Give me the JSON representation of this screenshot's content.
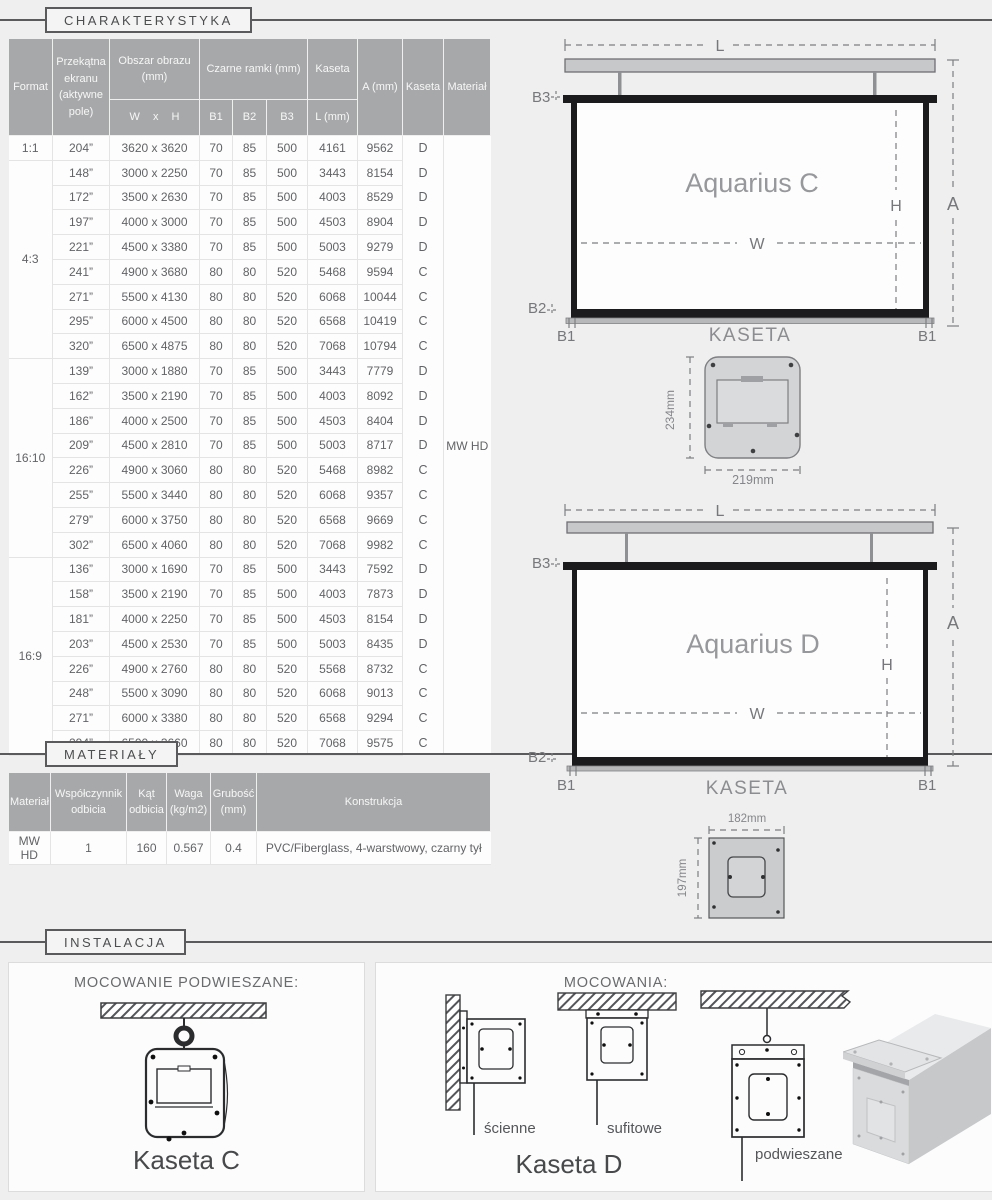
{
  "colors": {
    "accent": "#5a5a5c",
    "table_header": "#a7a8aa",
    "page_bg": "#efefef"
  },
  "sections": {
    "charakterystyka": "CHARAKTERYSTYKA",
    "materialy": "MATERIAŁY",
    "instalacja": "INSTALACJA"
  },
  "spec_table": {
    "header": {
      "format": "Format",
      "diagonal": "Przekątna ekranu (aktywne pole)",
      "image_area": "Obszar obrazu (mm)",
      "image_area_sub": "W x H",
      "black_frames": "Czarne ramki (mm)",
      "b1": "B1",
      "b2": "B2",
      "b3": "B3",
      "kaseta": "Kaseta",
      "kaseta_sub": "L (mm)",
      "a": "A (mm)",
      "kaseta2": "Kaseta",
      "material": "Materiał"
    },
    "material_value": "MW HD",
    "groups": [
      {
        "format": "1:1",
        "rows": [
          [
            "204”",
            "3620 x 3620",
            "70",
            "85",
            "500",
            "4161",
            "9562",
            "D"
          ]
        ]
      },
      {
        "format": "4:3",
        "rows": [
          [
            "148”",
            "3000 x 2250",
            "70",
            "85",
            "500",
            "3443",
            "8154",
            "D"
          ],
          [
            "172”",
            "3500 x 2630",
            "70",
            "85",
            "500",
            "4003",
            "8529",
            "D"
          ],
          [
            "197”",
            "4000 x 3000",
            "70",
            "85",
            "500",
            "4503",
            "8904",
            "D"
          ],
          [
            "221”",
            "4500 x 3380",
            "70",
            "85",
            "500",
            "5003",
            "9279",
            "D"
          ],
          [
            "241”",
            "4900 x 3680",
            "80",
            "80",
            "520",
            "5468",
            "9594",
            "C"
          ],
          [
            "271”",
            "5500 x 4130",
            "80",
            "80",
            "520",
            "6068",
            "10044",
            "C"
          ],
          [
            "295”",
            "6000 x 4500",
            "80",
            "80",
            "520",
            "6568",
            "10419",
            "C"
          ],
          [
            "320”",
            "6500 x 4875",
            "80",
            "80",
            "520",
            "7068",
            "10794",
            "C"
          ]
        ]
      },
      {
        "format": "16:10",
        "rows": [
          [
            "139”",
            "3000 x 1880",
            "70",
            "85",
            "500",
            "3443",
            "7779",
            "D"
          ],
          [
            "162”",
            "3500 x 2190",
            "70",
            "85",
            "500",
            "4003",
            "8092",
            "D"
          ],
          [
            "186”",
            "4000 x 2500",
            "70",
            "85",
            "500",
            "4503",
            "8404",
            "D"
          ],
          [
            "209”",
            "4500 x 2810",
            "70",
            "85",
            "500",
            "5003",
            "8717",
            "D"
          ],
          [
            "226”",
            "4900 x 3060",
            "80",
            "80",
            "520",
            "5468",
            "8982",
            "C"
          ],
          [
            "255”",
            "5500 x 3440",
            "80",
            "80",
            "520",
            "6068",
            "9357",
            "C"
          ],
          [
            "279”",
            "6000 x 3750",
            "80",
            "80",
            "520",
            "6568",
            "9669",
            "C"
          ],
          [
            "302”",
            "6500 x 4060",
            "80",
            "80",
            "520",
            "7068",
            "9982",
            "C"
          ]
        ]
      },
      {
        "format": "16:9",
        "rows": [
          [
            "136”",
            "3000 x 1690",
            "70",
            "85",
            "500",
            "3443",
            "7592",
            "D"
          ],
          [
            "158”",
            "3500 x 2190",
            "70",
            "85",
            "500",
            "4003",
            "7873",
            "D"
          ],
          [
            "181”",
            "4000 x 2250",
            "70",
            "85",
            "500",
            "4503",
            "8154",
            "D"
          ],
          [
            "203”",
            "4500 x 2530",
            "70",
            "85",
            "500",
            "5003",
            "8435",
            "D"
          ],
          [
            "226”",
            "4900 x 2760",
            "80",
            "80",
            "520",
            "5568",
            "8732",
            "C"
          ],
          [
            "248”",
            "5500 x 3090",
            "80",
            "80",
            "520",
            "6068",
            "9013",
            "C"
          ],
          [
            "271”",
            "6000 x 3380",
            "80",
            "80",
            "520",
            "6568",
            "9294",
            "C"
          ],
          [
            "294”",
            "6500 x 3660",
            "80",
            "80",
            "520",
            "7068",
            "9575",
            "C"
          ]
        ]
      }
    ]
  },
  "materials_table": {
    "header": {
      "material": "Materiał",
      "reflection": "Współczynnik odbicia",
      "angle": "Kąt odbicia",
      "weight": "Waga (kg/m2)",
      "thickness": "Grubość (mm)",
      "construction": "Konstrukcja"
    },
    "rows": [
      [
        "MW HD",
        "1",
        "160",
        "0.567",
        "0.4",
        "PVC/Fiberglass, 4-warstwowy, czarny tył"
      ]
    ]
  },
  "diagram_c": {
    "title": "Aquarius C",
    "kaseta_caption": "KASETA",
    "dim_l": "L",
    "dim_a": "A",
    "dim_h": "H",
    "dim_w": "W",
    "dim_b1": "B1",
    "dim_b2": "B2",
    "dim_b3": "B3",
    "cross_height": "234mm",
    "cross_width": "219mm"
  },
  "diagram_d": {
    "title": "Aquarius D",
    "kaseta_caption": "KASETA",
    "dim_l": "L",
    "dim_a": "A",
    "dim_h": "H",
    "dim_w": "W",
    "dim_b1": "B1",
    "dim_b2": "B2",
    "dim_b3": "B3",
    "cross_width": "182mm",
    "cross_height": "197mm"
  },
  "installation": {
    "left_panel": {
      "title": "MOCOWANIE PODWIESZANE:",
      "caption": "Kaseta C"
    },
    "right_panel": {
      "title": "MOCOWANIA:",
      "caption": "Kaseta D",
      "labels": {
        "wall": "ścienne",
        "ceiling": "sufitowe",
        "suspended": "podwieszane"
      }
    }
  }
}
